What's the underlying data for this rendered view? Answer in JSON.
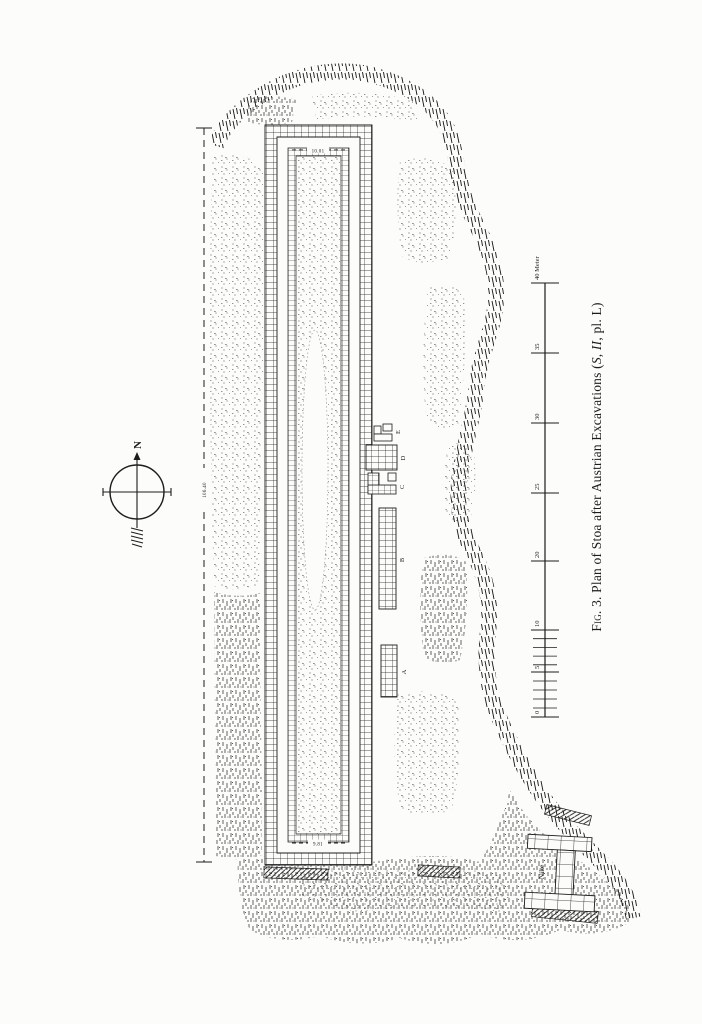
{
  "figure": {
    "caption": {
      "fig_label": "Fig. 3.",
      "text": " Plan of Stoa after Austrian Excavations (",
      "italic": "S, II",
      "suffix": ", pl. L)"
    }
  },
  "compass": {
    "north_label": "N"
  },
  "scale_bar": {
    "unit": "Meter",
    "labels": [
      "40 Meter",
      "35",
      "30",
      "25",
      "20",
      "10",
      "5",
      "0"
    ]
  },
  "dimensions": {
    "top_width": "10.01",
    "bottom_width": "9.81",
    "length": "106.40"
  },
  "structures": {
    "a": "A",
    "b": "B",
    "c": "C",
    "d": "D",
    "e": "E",
    "nike": "Nike"
  },
  "ink_color": "#1c1c1c"
}
